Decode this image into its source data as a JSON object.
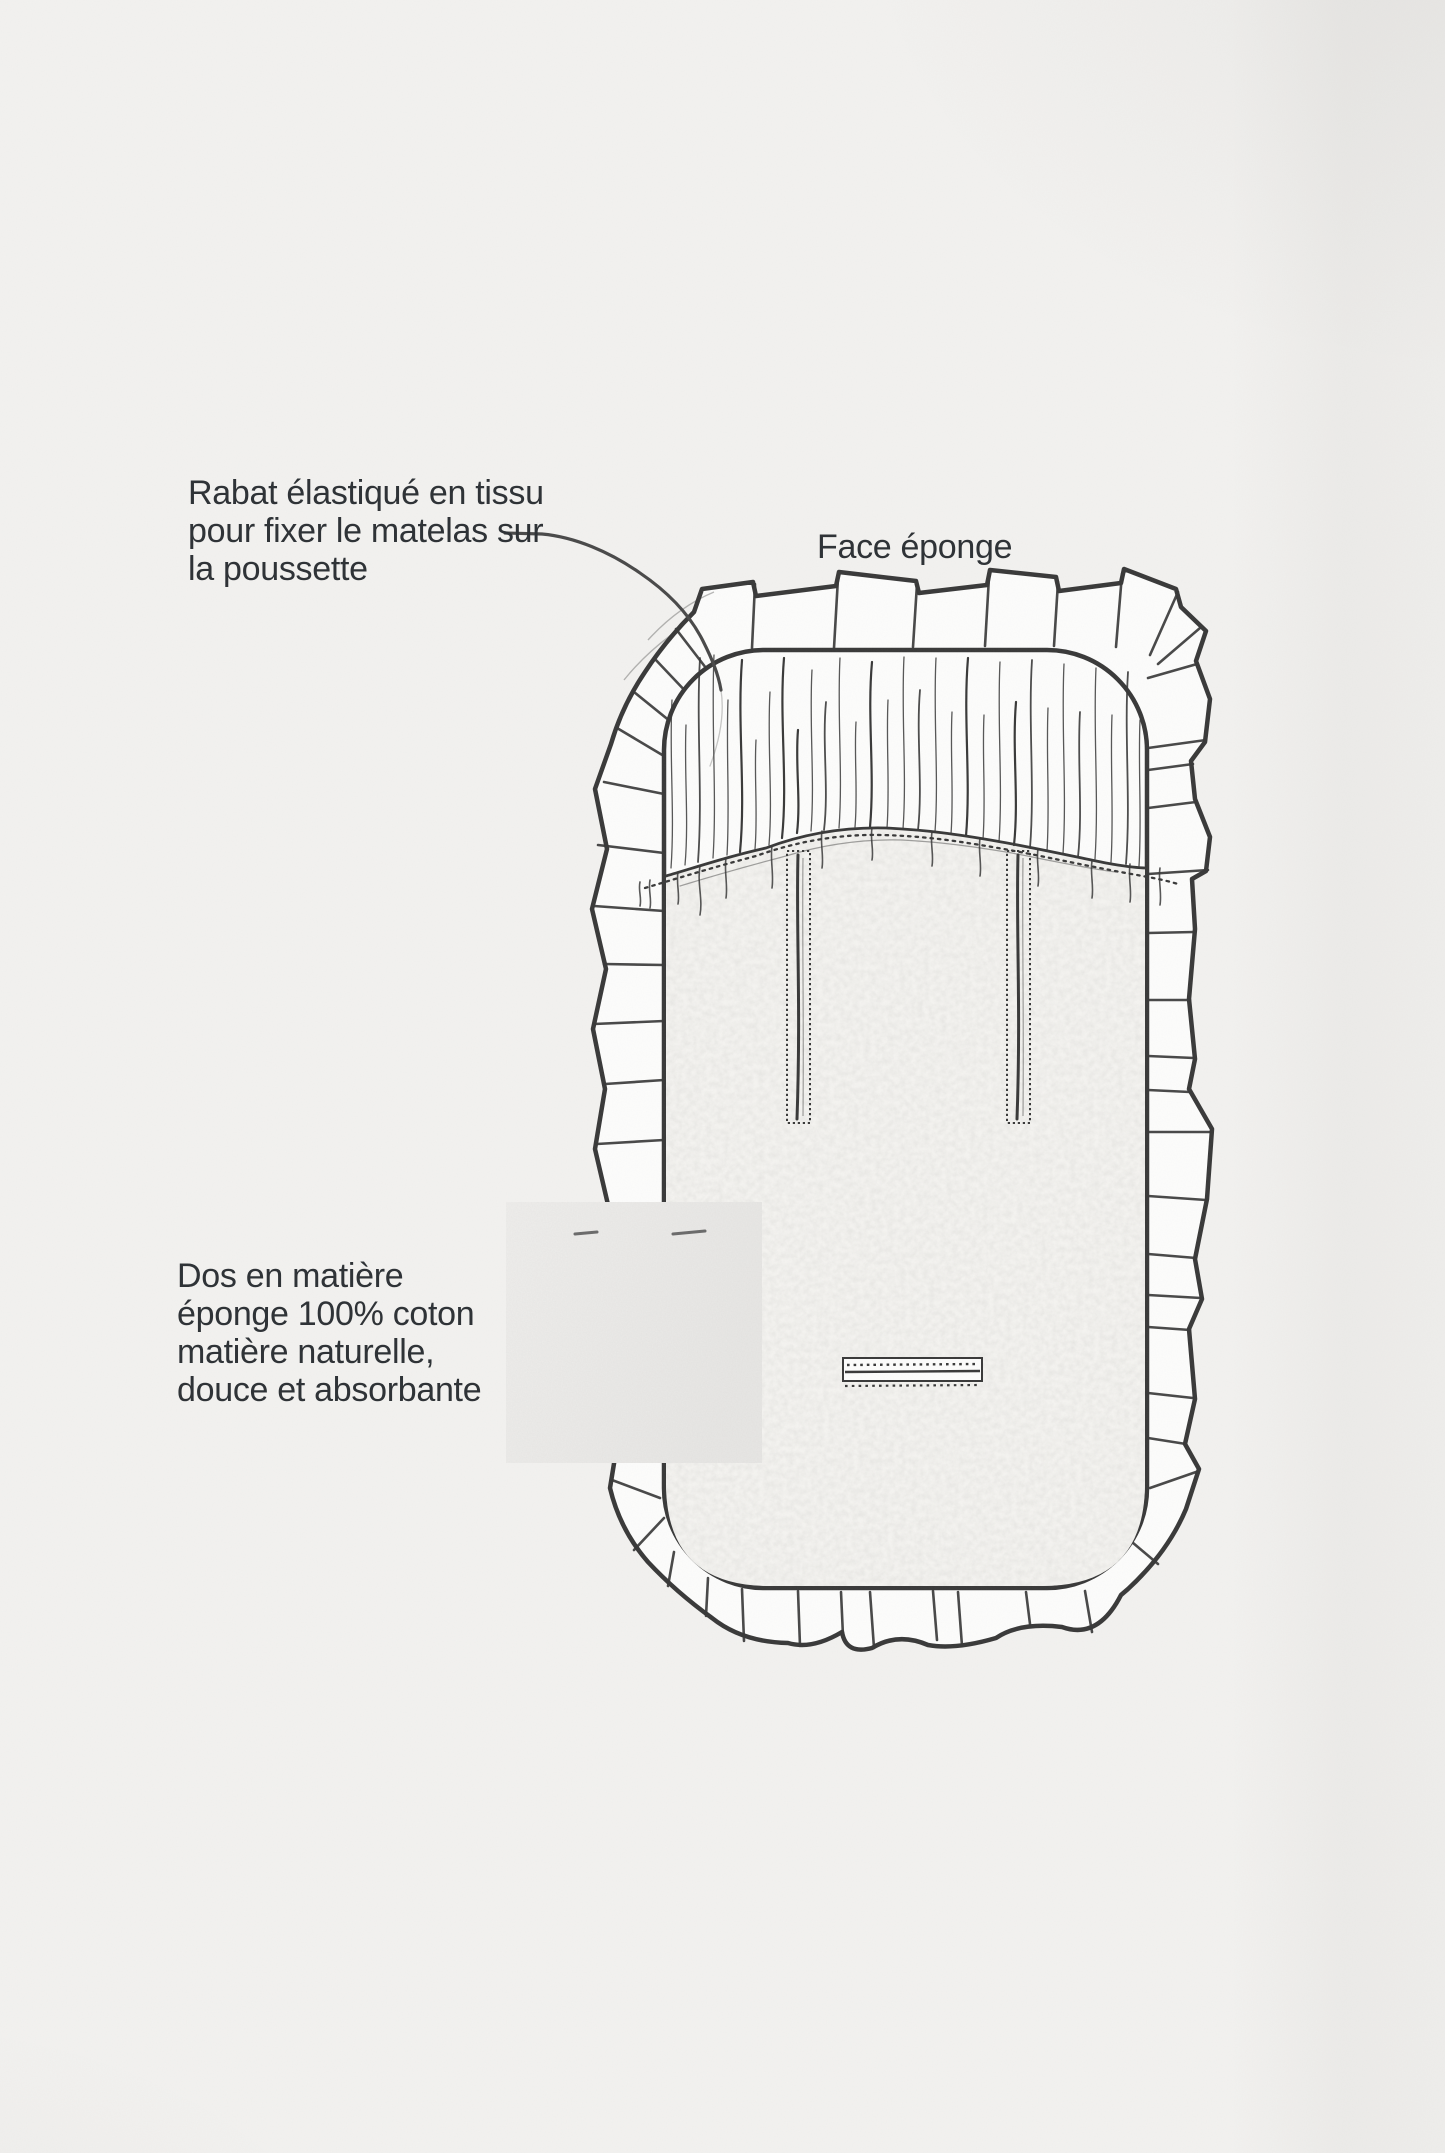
{
  "colors": {
    "bg": "#f2f1ef",
    "ink": "#3a3a3a",
    "text": "#2f3337",
    "paper": "#fcfcfb",
    "terry": "#f4f3f0",
    "swatch1": "#eeedeb",
    "swatch2": "#e7e6e4"
  },
  "annotations": {
    "rabat": {
      "lines": [
        "Rabat élastiqué en tissu",
        "pour fixer le matelas sur",
        "la poussette"
      ]
    },
    "face": {
      "text": "Face éponge"
    },
    "dos": {
      "lines": [
        "Dos en matière",
        "éponge 100% coton",
        "matière naturelle,",
        "douce et absorbante"
      ]
    }
  }
}
